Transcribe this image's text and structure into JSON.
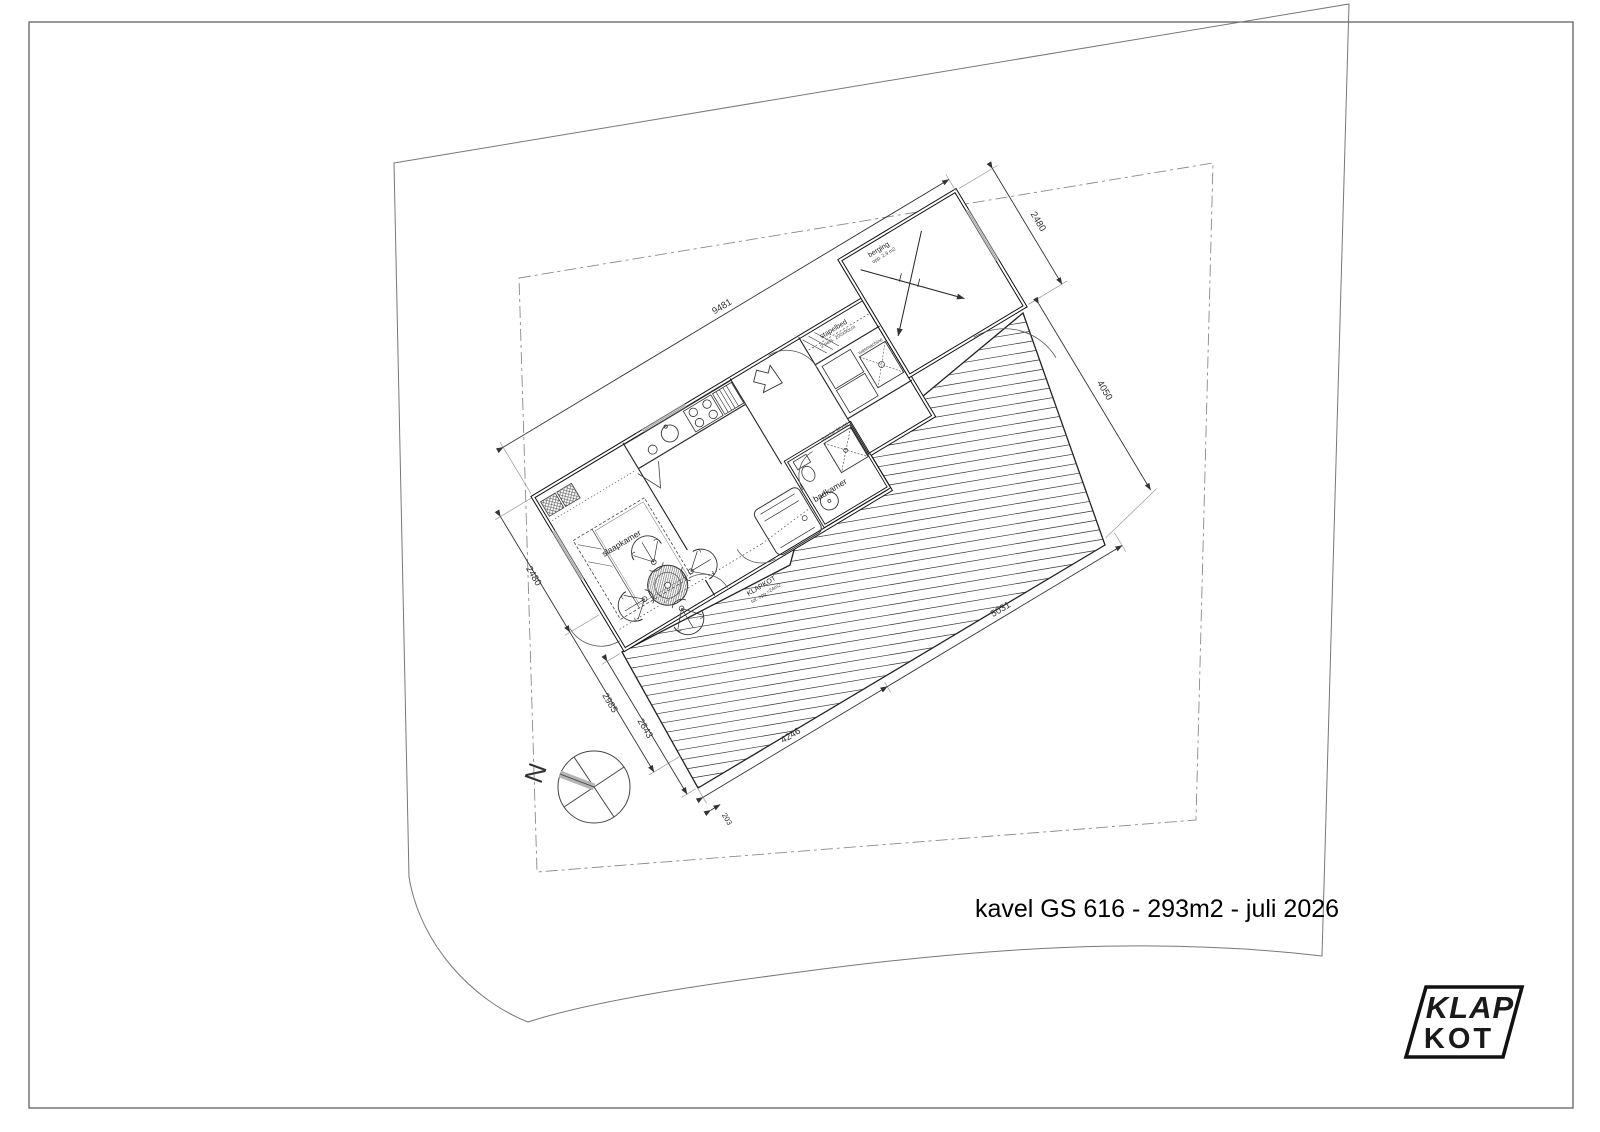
{
  "page": {
    "title": "kavel GS 616 - 293m2 - juli 2026"
  },
  "logo": {
    "top": "KLAP",
    "bottom": "KOT"
  },
  "compass": {
    "north": "N"
  },
  "plan": {
    "rooms": {
      "bedroom": "slaapkamer",
      "bathroom": "badkamer",
      "bunk": "stapelbed",
      "storage": "berging"
    },
    "sublabels": {
      "bunk_size": "2 pers. 200x90cm",
      "storage_area": "opp. 2,9 m2",
      "shower": "douche 90x90",
      "washer": "wasmachine"
    },
    "area_label": {
      "line1": "KLAPKOT",
      "line2": "tot. opp.=24m2"
    },
    "dims": {
      "top": "9481",
      "storage_width": "2480",
      "right": "4050",
      "deck_se": "5031",
      "deck_bottom": "4246",
      "deck_small": "203",
      "deck_west": "2643",
      "left_lower": "2985",
      "left_upper": "2480"
    }
  }
}
